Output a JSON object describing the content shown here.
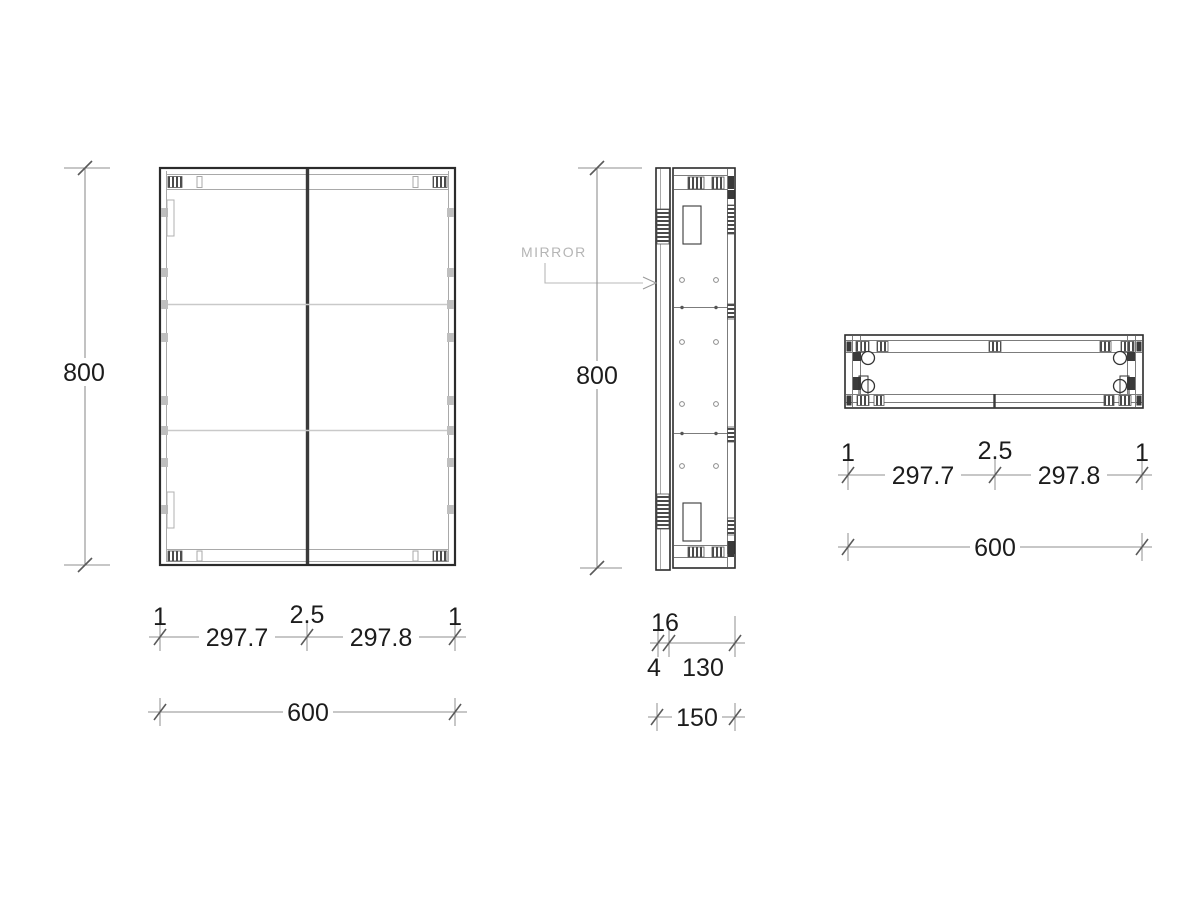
{
  "drawing": {
    "type": "cabinet technical drawing, three orthographic views",
    "annotations": {
      "mirror_label": "MIRROR"
    },
    "front_view": {
      "height": "800",
      "edge_left": "1",
      "door_left": "297.7",
      "center_gap": "2.5",
      "door_right": "297.8",
      "edge_right": "1",
      "width": "600"
    },
    "side_view": {
      "height": "800",
      "door_thickness": "16",
      "reveal_gap": "4",
      "carcass_depth": "130",
      "total_depth": "150"
    },
    "top_view": {
      "edge_left": "1",
      "door_left": "297.7",
      "center_gap": "2.5",
      "door_right": "297.8",
      "edge_right": "1",
      "width": "600"
    },
    "colors": {
      "background": "#ffffff",
      "outline": "#2b2b2b",
      "detail_gray": "#a9a9a9",
      "shelf_gray": "#c9c9c9",
      "dim_line": "#8f8f8f",
      "dim_text": "#1c1c1c",
      "mirror_label": "#b5b5b5",
      "hatch": "#3a3a3a"
    }
  }
}
